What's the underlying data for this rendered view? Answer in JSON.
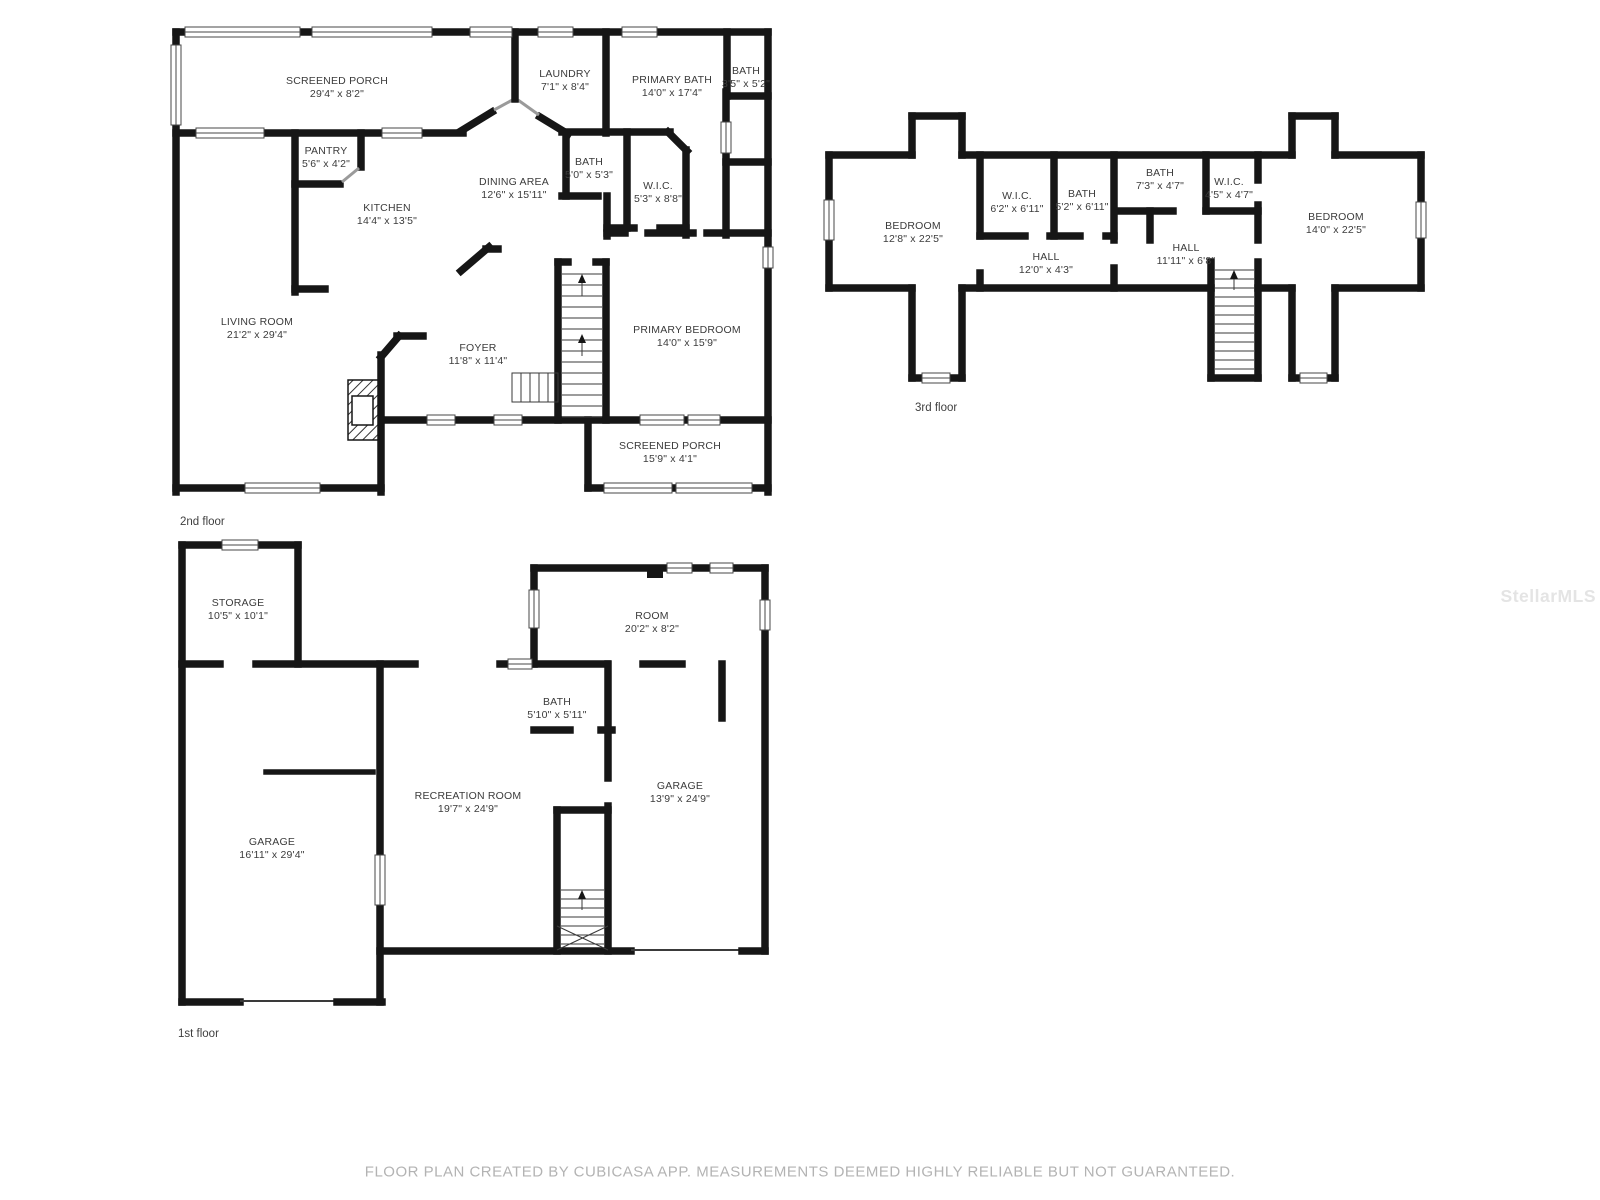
{
  "floors": {
    "second": {
      "label": "2nd floor",
      "rooms": {
        "screened_porch_top": {
          "name": "SCREENED PORCH",
          "dims": "29'4\" x 8'2\""
        },
        "laundry": {
          "name": "LAUNDRY",
          "dims": "7'1\" x 8'4\""
        },
        "primary_bath": {
          "name": "PRIMARY BATH",
          "dims": "14'0\" x 17'4\""
        },
        "bath_small": {
          "name": "BATH",
          "dims": "3'5\" x 5'2\""
        },
        "pantry": {
          "name": "PANTRY",
          "dims": "5'6\" x 4'2\""
        },
        "kitchen": {
          "name": "KITCHEN",
          "dims": "14'4\" x 13'5\""
        },
        "dining_area": {
          "name": "DINING AREA",
          "dims": "12'6\" x 15'11\""
        },
        "bath_mid": {
          "name": "BATH",
          "dims": "5'0\" x 5'3\""
        },
        "wic": {
          "name": "W.I.C.",
          "dims": "5'3\" x 8'8\""
        },
        "living_room": {
          "name": "LIVING ROOM",
          "dims": "21'2\" x 29'4\""
        },
        "foyer": {
          "name": "FOYER",
          "dims": "11'8\" x 11'4\""
        },
        "primary_bedroom": {
          "name": "PRIMARY BEDROOM",
          "dims": "14'0\" x 15'9\""
        },
        "screened_porch_bottom": {
          "name": "SCREENED PORCH",
          "dims": "15'9\" x 4'1\""
        }
      }
    },
    "third": {
      "label": "3rd floor",
      "rooms": {
        "bedroom_left": {
          "name": "BEDROOM",
          "dims": "12'8\" x 22'5\""
        },
        "wic_left": {
          "name": "W.I.C.",
          "dims": "6'2\" x 6'11\""
        },
        "bath_left": {
          "name": "BATH",
          "dims": "5'2\" x 6'11\""
        },
        "bath_right": {
          "name": "BATH",
          "dims": "7'3\" x 4'7\""
        },
        "wic_right": {
          "name": "W.I.C.",
          "dims": "4'5\" x 4'7\""
        },
        "hall_left": {
          "name": "HALL",
          "dims": "12'0\" x 4'3\""
        },
        "hall_right": {
          "name": "HALL",
          "dims": "11'11\" x 6'8\""
        },
        "bedroom_right": {
          "name": "BEDROOM",
          "dims": "14'0\" x 22'5\""
        }
      }
    },
    "first": {
      "label": "1st floor",
      "rooms": {
        "storage": {
          "name": "STORAGE",
          "dims": "10'5\" x 10'1\""
        },
        "room": {
          "name": "ROOM",
          "dims": "20'2\" x 8'2\""
        },
        "bath": {
          "name": "BATH",
          "dims": "5'10\" x 5'11\""
        },
        "garage_left": {
          "name": "GARAGE",
          "dims": "16'11\" x 29'4\""
        },
        "recreation": {
          "name": "RECREATION ROOM",
          "dims": "19'7\" x 24'9\""
        },
        "garage_right": {
          "name": "GARAGE",
          "dims": "13'9\" x 24'9\""
        }
      }
    }
  },
  "footer": "FLOOR PLAN CREATED BY CUBICASA APP. MEASUREMENTS DEEMED HIGHLY RELIABLE BUT NOT GUARANTEED.",
  "watermark": "StellarMLS"
}
